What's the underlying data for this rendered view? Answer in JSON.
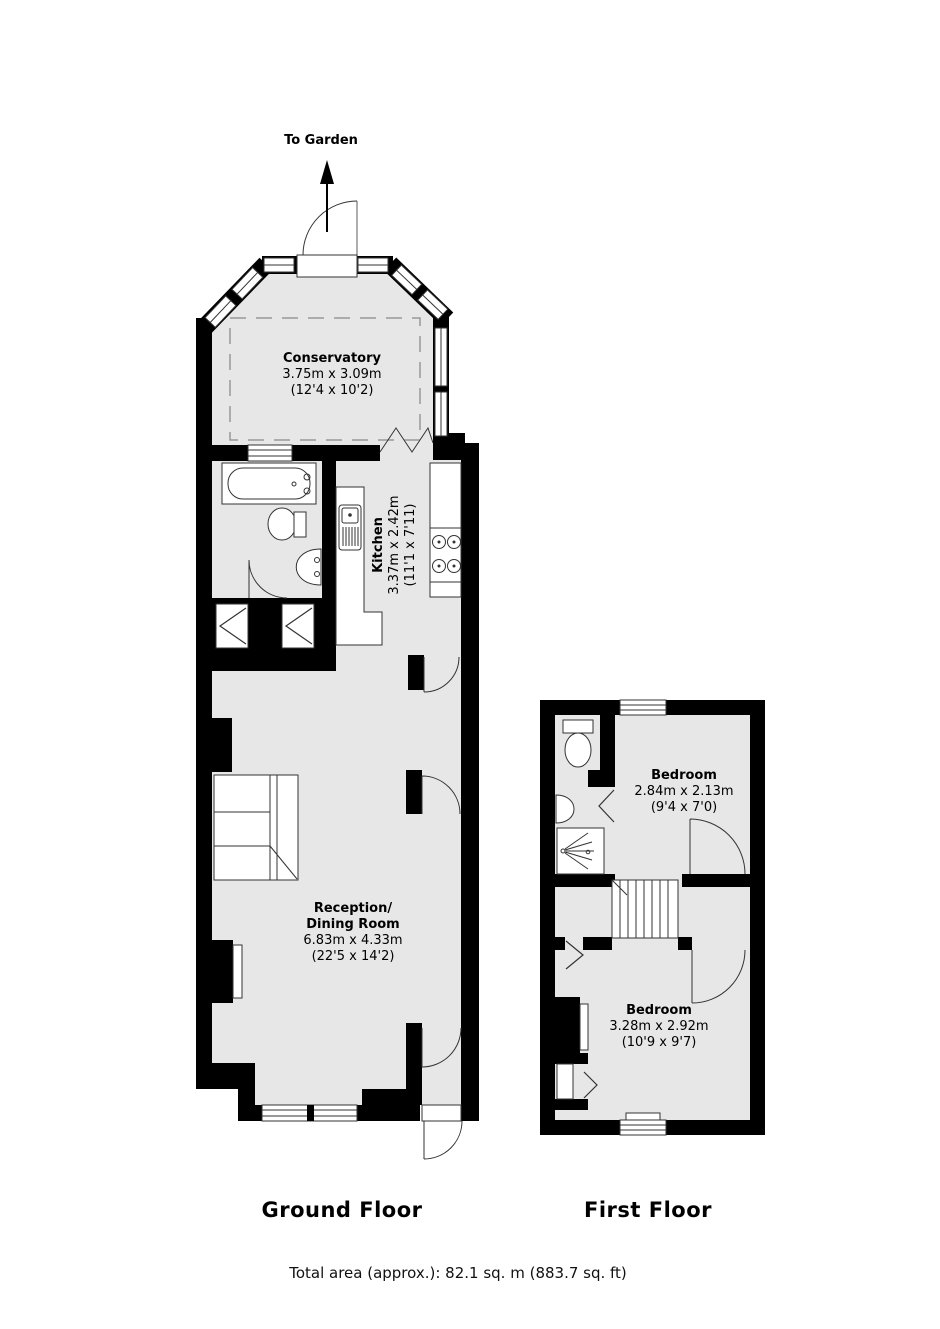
{
  "garden": {
    "label": "To Garden"
  },
  "ground_floor": {
    "label": "Ground Floor",
    "rooms": {
      "conservatory": {
        "name": "Conservatory",
        "dims_m": "3.75m x 3.09m",
        "dims_ft": "(12'4 x 10'2)"
      },
      "kitchen": {
        "name": "Kitchen",
        "dims_m": "3.37m x 2.42m",
        "dims_ft": "(11'1 x 7'11)"
      },
      "reception": {
        "name_line1": "Reception/",
        "name_line2": "Dining Room",
        "dims_m": "6.83m x 4.33m",
        "dims_ft": "(22'5 x 14'2)"
      }
    }
  },
  "first_floor": {
    "label": "First Floor",
    "rooms": {
      "bedroom_front": {
        "name": "Bedroom",
        "dims_m": "2.84m x 2.13m",
        "dims_ft": "(9'4 x 7'0)"
      },
      "bedroom_back": {
        "name": "Bedroom",
        "dims_m": "3.28m x 2.92m",
        "dims_ft": "(10'9 x 9'7)"
      }
    }
  },
  "footer": {
    "total_area": "Total area (approx.): 82.1 sq. m (883.7 sq. ft)"
  },
  "colors": {
    "wall": "#000000",
    "floor_fill": "#e7e7e7",
    "background": "#ffffff",
    "detail_line": "#333333",
    "dashed_roof": "#999999"
  }
}
